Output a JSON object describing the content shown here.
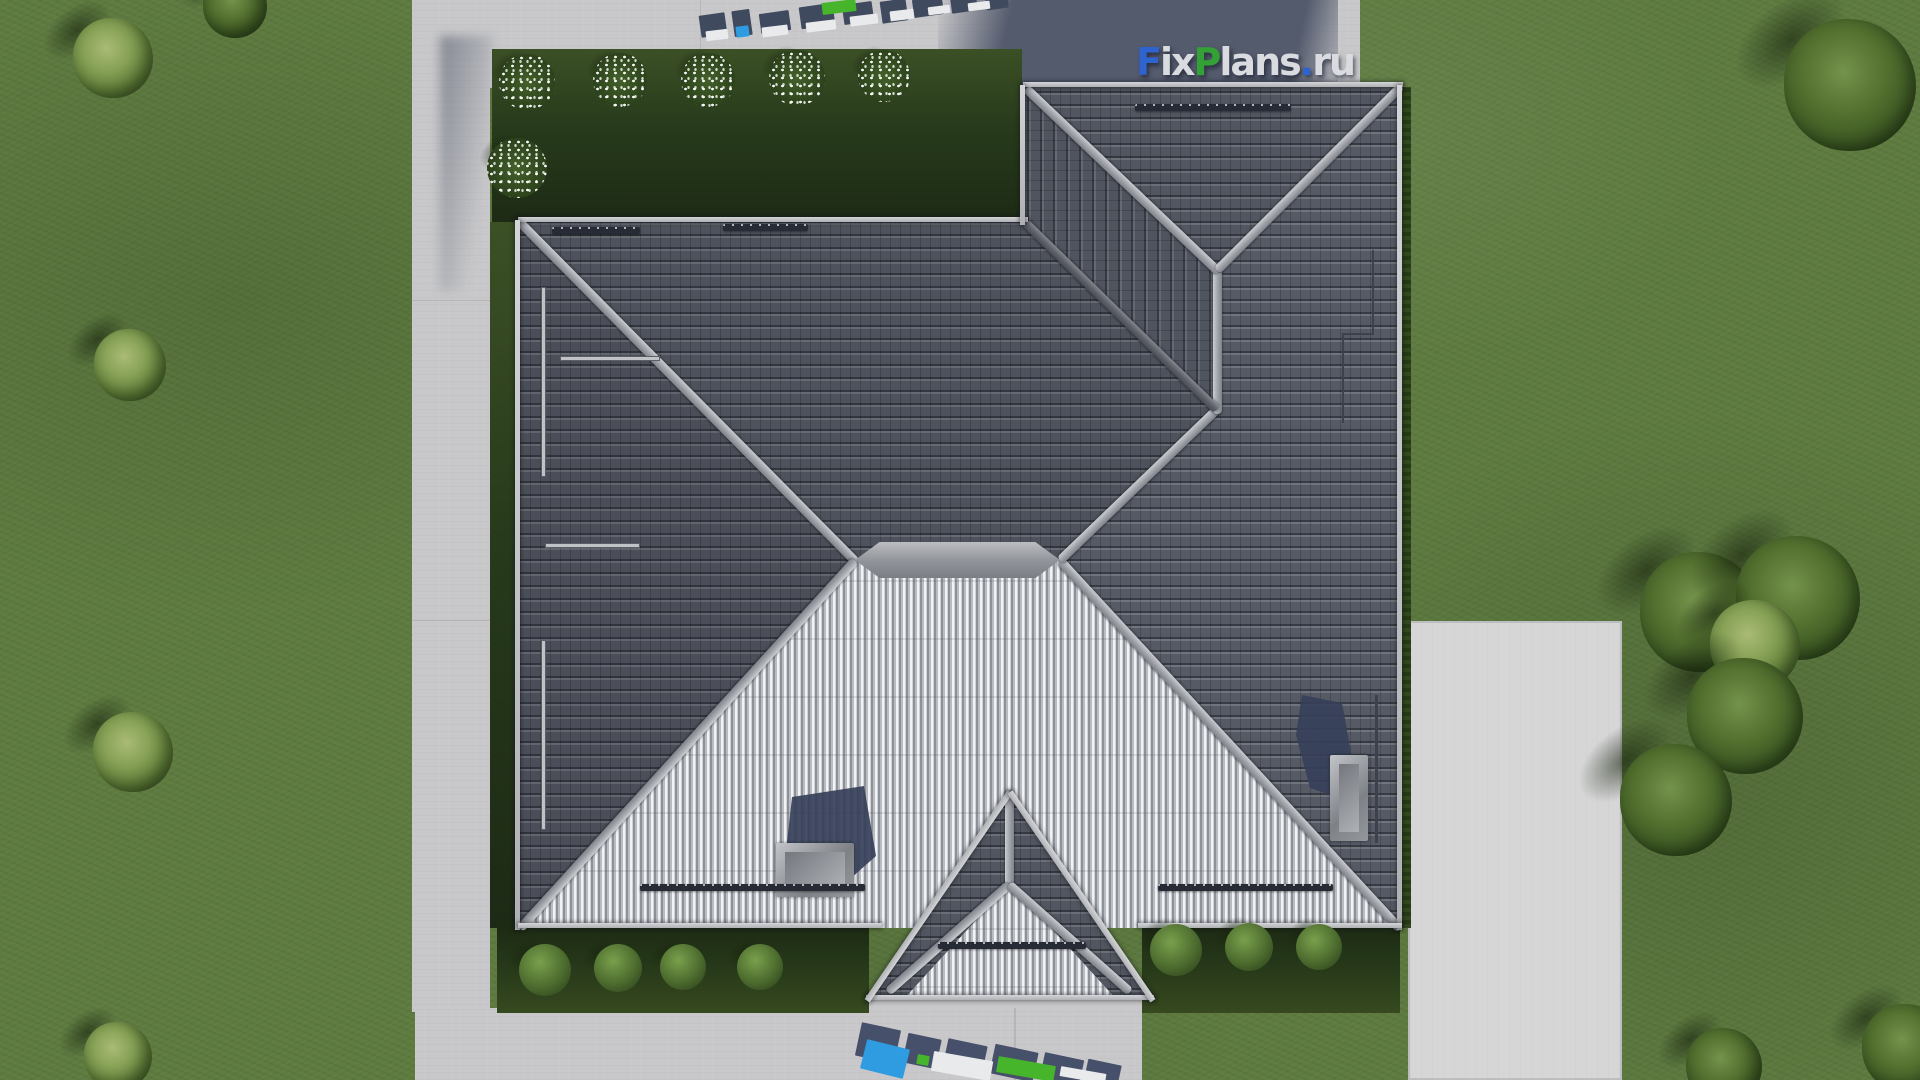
{
  "watermark": {
    "text": "FixPlans.ru",
    "letters": [
      {
        "ch": "F",
        "color": "#2e64cf"
      },
      {
        "ch": "i",
        "color": "#d9dbe0"
      },
      {
        "ch": "x",
        "color": "#d9dbe0"
      },
      {
        "ch": "P",
        "color": "#34a136"
      },
      {
        "ch": "l",
        "color": "#d9dbe0"
      },
      {
        "ch": "a",
        "color": "#d9dbe0"
      },
      {
        "ch": "n",
        "color": "#d9dbe0"
      },
      {
        "ch": "s",
        "color": "#d9dbe0"
      },
      {
        "ch": ".",
        "color": "#2e64cf"
      },
      {
        "ch": "r",
        "color": "#d9dbe0"
      },
      {
        "ch": "u",
        "color": "#d9dbe0"
      }
    ],
    "position": {
      "x": 1136,
      "y": 40
    }
  },
  "colors": {
    "grass": "#5e7b40",
    "garden_dark": "#273a1b",
    "path": "#c8c8ca",
    "driveway": "#d6d6d7",
    "roof_dark": "#51555f",
    "roof_ribs_light": "#c0c3c8",
    "ridge": "#a5a8ae",
    "building_shadow": "#4e5568",
    "tree_shadow": "#1a240e",
    "wm_blue": "#2e64cf",
    "wm_green": "#34a136",
    "wm_grey": "#d9dbe0",
    "frag_shadow": "#46506a",
    "frag_face": "#e9eaec",
    "frag_blue": "#2f9be0",
    "frag_green": "#46b52c"
  },
  "vegetation": {
    "trees": [
      {
        "x": 113,
        "y": 58,
        "r": 40,
        "tone": "light"
      },
      {
        "x": 235,
        "y": 6,
        "r": 32,
        "tone": "dark"
      },
      {
        "x": 130,
        "y": 365,
        "r": 36,
        "tone": "light"
      },
      {
        "x": 133,
        "y": 752,
        "r": 40,
        "tone": "light"
      },
      {
        "x": 118,
        "y": 1056,
        "r": 34,
        "tone": "light"
      },
      {
        "x": 1850,
        "y": 85,
        "r": 66,
        "tone": "dark"
      },
      {
        "x": 1700,
        "y": 612,
        "r": 60,
        "tone": "dark"
      },
      {
        "x": 1798,
        "y": 598,
        "r": 62,
        "tone": "dark"
      },
      {
        "x": 1755,
        "y": 645,
        "r": 45,
        "tone": "light"
      },
      {
        "x": 1745,
        "y": 716,
        "r": 58,
        "tone": "dark"
      },
      {
        "x": 1676,
        "y": 800,
        "r": 56,
        "tone": "dark"
      },
      {
        "x": 1724,
        "y": 1066,
        "r": 38,
        "tone": "dark"
      },
      {
        "x": 1906,
        "y": 1048,
        "r": 44,
        "tone": "dark"
      }
    ],
    "bushes": [
      {
        "x": 545,
        "y": 970,
        "r": 26
      },
      {
        "x": 618,
        "y": 968,
        "r": 24
      },
      {
        "x": 683,
        "y": 967,
        "r": 23
      },
      {
        "x": 760,
        "y": 967,
        "r": 23
      },
      {
        "x": 1176,
        "y": 950,
        "r": 26
      },
      {
        "x": 1249,
        "y": 947,
        "r": 24
      },
      {
        "x": 1319,
        "y": 947,
        "r": 23
      }
    ],
    "flower_bushes": [
      {
        "x": 527,
        "y": 82,
        "r": 28
      },
      {
        "x": 620,
        "y": 80,
        "r": 27
      },
      {
        "x": 708,
        "y": 80,
        "r": 27
      },
      {
        "x": 797,
        "y": 78,
        "r": 28
      },
      {
        "x": 884,
        "y": 76,
        "r": 26
      },
      {
        "x": 517,
        "y": 168,
        "r": 30
      }
    ]
  },
  "roof_hardware": {
    "snow_guards": [
      {
        "x": 552,
        "y": 227,
        "w": 88
      },
      {
        "x": 723,
        "y": 224,
        "w": 85
      },
      {
        "x": 1135,
        "y": 104,
        "w": 156
      },
      {
        "x": 640,
        "y": 884,
        "w": 225
      },
      {
        "x": 1158,
        "y": 884,
        "w": 175
      },
      {
        "x": 938,
        "y": 942,
        "w": 148
      }
    ],
    "ladders": [
      {
        "x": 541,
        "y": 287,
        "w": 5,
        "h": 190
      },
      {
        "x": 541,
        "y": 640,
        "w": 5,
        "h": 190
      },
      {
        "x": 545,
        "y": 543,
        "w": 95,
        "h": 5
      },
      {
        "x": 560,
        "y": 356,
        "w": 100,
        "h": 5
      }
    ],
    "rods": [
      {
        "x": 1375,
        "y": 695,
        "w": 3,
        "h": 148
      },
      {
        "x": 1372,
        "y": 250,
        "w": 2,
        "h": 85
      },
      {
        "x": 1342,
        "y": 333,
        "w": 32,
        "h": 2
      },
      {
        "x": 1342,
        "y": 333,
        "w": 2,
        "h": 90
      }
    ]
  },
  "watermark_fragments": {
    "top": [
      {
        "x": 700,
        "y": 14,
        "w": 26,
        "h": 22,
        "c": "#3f4a5e",
        "rot": -8
      },
      {
        "x": 733,
        "y": 10,
        "w": 18,
        "h": 26,
        "c": "#3f4a5e",
        "rot": -8
      },
      {
        "x": 760,
        "y": 12,
        "w": 30,
        "h": 20,
        "c": "#3f4a5e",
        "rot": -8
      },
      {
        "x": 800,
        "y": 5,
        "w": 34,
        "h": 22,
        "c": "#3f4a5e",
        "rot": -8
      },
      {
        "x": 843,
        "y": 3,
        "w": 30,
        "h": 20,
        "c": "#3f4a5e",
        "rot": -8
      },
      {
        "x": 881,
        "y": 0,
        "w": 26,
        "h": 22,
        "c": "#3f4a5e",
        "rot": -8
      },
      {
        "x": 913,
        "y": -2,
        "w": 30,
        "h": 18,
        "c": "#3f4a5e",
        "rot": -8
      },
      {
        "x": 951,
        "y": -4,
        "w": 26,
        "h": 16,
        "c": "#3f4a5e",
        "rot": -8
      },
      {
        "x": 986,
        "y": -5,
        "w": 22,
        "h": 14,
        "c": "#3f4a5e",
        "rot": -8
      },
      {
        "x": 706,
        "y": 30,
        "w": 22,
        "h": 10,
        "c": "#e9eaec",
        "rot": -7
      },
      {
        "x": 762,
        "y": 26,
        "w": 26,
        "h": 10,
        "c": "#e9eaec",
        "rot": -7
      },
      {
        "x": 806,
        "y": 21,
        "w": 30,
        "h": 10,
        "c": "#e9eaec",
        "rot": -7
      },
      {
        "x": 850,
        "y": 15,
        "w": 28,
        "h": 10,
        "c": "#e9eaec",
        "rot": -7
      },
      {
        "x": 890,
        "y": 10,
        "w": 24,
        "h": 10,
        "c": "#e9eaec",
        "rot": -7
      },
      {
        "x": 928,
        "y": 6,
        "w": 22,
        "h": 8,
        "c": "#e9eaec",
        "rot": -7
      },
      {
        "x": 968,
        "y": 2,
        "w": 22,
        "h": 8,
        "c": "#e9eaec",
        "rot": -7
      },
      {
        "x": 736,
        "y": 26,
        "w": 13,
        "h": 11,
        "c": "#2f9be0",
        "rot": -7
      },
      {
        "x": 822,
        "y": 1,
        "w": 34,
        "h": 12,
        "c": "#46b52c",
        "rot": -7
      }
    ],
    "bottom": [
      {
        "x": 858,
        "y": 1026,
        "w": 40,
        "h": 34,
        "c": "#46506a",
        "rot": 12
      },
      {
        "x": 905,
        "y": 1036,
        "w": 34,
        "h": 30,
        "c": "#46506a",
        "rot": 12
      },
      {
        "x": 945,
        "y": 1042,
        "w": 40,
        "h": 30,
        "c": "#46506a",
        "rot": 12
      },
      {
        "x": 992,
        "y": 1048,
        "w": 44,
        "h": 30,
        "c": "#46506a",
        "rot": 12
      },
      {
        "x": 1042,
        "y": 1056,
        "w": 40,
        "h": 26,
        "c": "#46506a",
        "rot": 12
      },
      {
        "x": 1086,
        "y": 1062,
        "w": 34,
        "h": 20,
        "c": "#46506a",
        "rot": 12
      },
      {
        "x": 863,
        "y": 1044,
        "w": 44,
        "h": 30,
        "c": "#2f9be0",
        "rot": 14
      },
      {
        "x": 917,
        "y": 1055,
        "w": 12,
        "h": 10,
        "c": "#46b52c",
        "rot": 10
      },
      {
        "x": 997,
        "y": 1061,
        "w": 58,
        "h": 16,
        "c": "#46b52c",
        "rot": 10
      },
      {
        "x": 932,
        "y": 1056,
        "w": 60,
        "h": 20,
        "c": "#e9eaec",
        "rot": 10
      },
      {
        "x": 1060,
        "y": 1070,
        "w": 46,
        "h": 10,
        "c": "#e9eaec",
        "rot": 10
      }
    ]
  }
}
